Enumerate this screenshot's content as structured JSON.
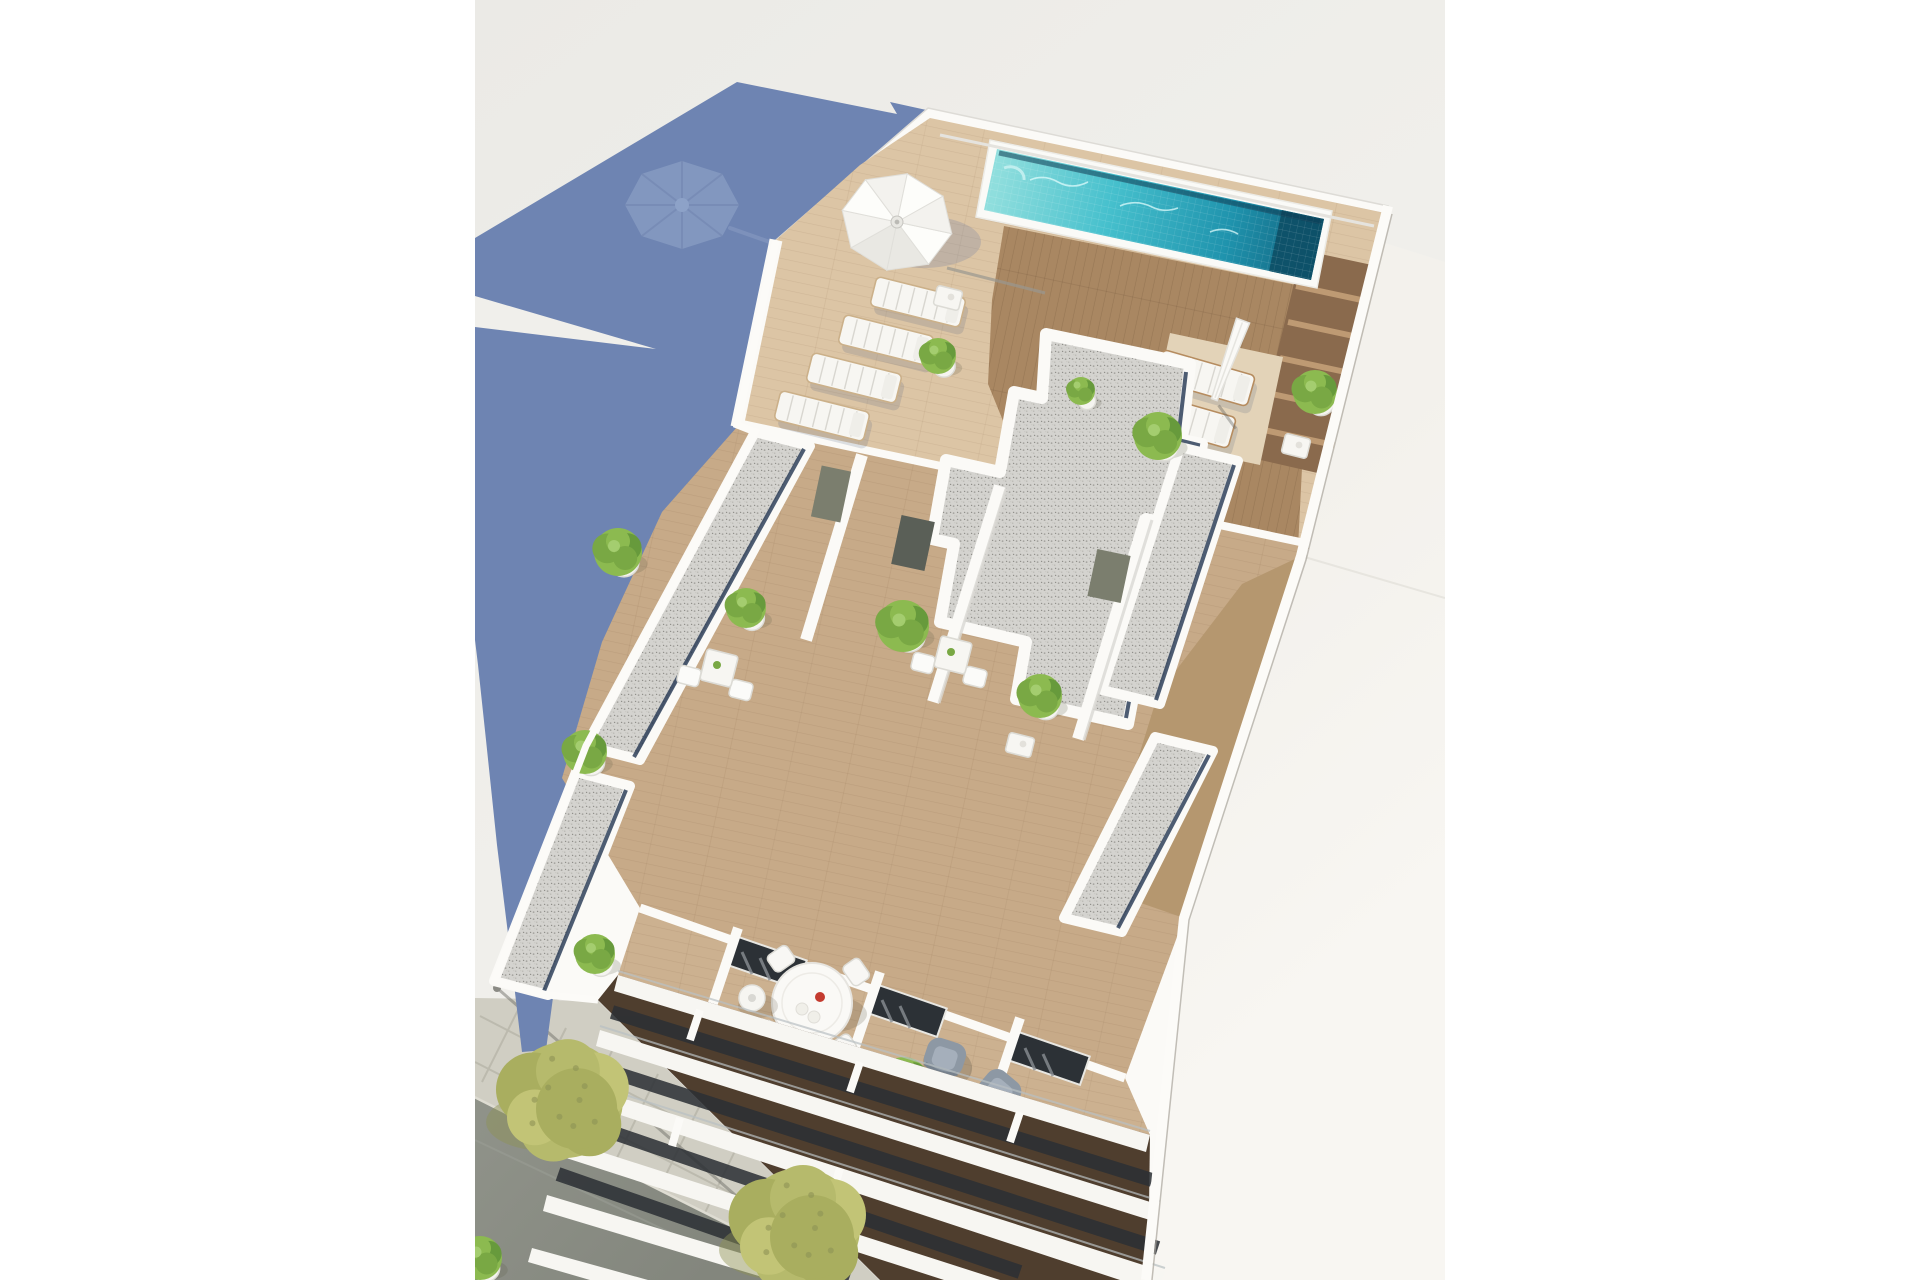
{
  "image": {
    "kind": "architectural-aerial-render",
    "description": "Aerial 3D rendering of a white residential building rooftop with a turquoise swimming pool, wooden deck terraces, sun loungers, white parasols, gravel flat roofs, cascading balconies and a tree-lined street below; a long blue building shadow is cast on the pale ground to the left."
  },
  "palette": {
    "page_bg": "#ffffff",
    "ground": "#ebeae6",
    "ground_mid": "#f0efeb",
    "ground_low": "#f3f2ed",
    "shadow_blue": "#6e84b2",
    "umbrella_shadow": "#93a7cb",
    "building_white": "#fbfaf7",
    "wall_shade": "#d9d8d3",
    "wall_edge": "#e5e3de",
    "deck_light": "#dcc5a5",
    "deck_warm": "#a98762",
    "deck_dark": "#8a6a4d",
    "deck_mat": "#e3d3b8",
    "wood_mid": "#c7aa88",
    "wood_right": "#b5976f",
    "wood_lt": "#ccb190",
    "recess_dark": "#4f3e2e",
    "gravel": "#d4d3cf",
    "gutter_navy": "#223450",
    "pool_light": "#8fdedd",
    "pool_mid": "#46c0cd",
    "pool_deep": "#1f93ad",
    "pool_dark": "#11607c",
    "pool_end": "#0d4f66",
    "road": "#8f9289",
    "road_low": "#83867d",
    "sidewalk": "#d0cec3",
    "paver_line": "#b9b7ab",
    "tree_a": "#b6ba6c",
    "tree_b": "#a9ae5f",
    "tree_c": "#c2c476",
    "tree_shadow": "#8e9355",
    "plant_a": "#8cba50",
    "plant_b": "#79a844",
    "plant_c": "#679a3c",
    "furniture_white": "#f7f6f2",
    "lounger_slat": "#d8d6d0",
    "armchair_gray": "#8d98a4",
    "glass_dark": "#2c3136",
    "door_olive": "#7b7e6e",
    "accent_red": "#c43b2f",
    "neigh_a": "#f3f1ec",
    "neigh_b": "#f8f6f2"
  },
  "scene": {
    "content_frame": {
      "x": 475,
      "y": 0,
      "width": 970,
      "height": 1280
    },
    "umbrella_shadow": {
      "x": 682,
      "y": 205,
      "rx": 57,
      "ry": 44
    },
    "parasol_roof": {
      "x": 897,
      "y": 222,
      "r": 56
    },
    "parasol_closed": {
      "x": 1228,
      "y": 362
    },
    "loungers_left": [
      {
        "x": 918,
        "y": 302
      },
      {
        "x": 886,
        "y": 340
      },
      {
        "x": 854,
        "y": 378
      },
      {
        "x": 822,
        "y": 416
      }
    ],
    "loungers_right": [
      {
        "x": 1205,
        "y": 378
      },
      {
        "x": 1186,
        "y": 420
      }
    ],
    "bistro_sets": [
      {
        "x": 719,
        "y": 668
      },
      {
        "x": 953,
        "y": 655
      }
    ],
    "side_tables": [
      {
        "x": 1020,
        "y": 745
      },
      {
        "x": 1296,
        "y": 446
      },
      {
        "x": 948,
        "y": 298
      }
    ],
    "dining_set": {
      "x": 812,
      "y": 1003,
      "r": 40
    },
    "floor_lamp": {
      "x": 752,
      "y": 998
    },
    "armchairs": [
      {
        "x": 945,
        "y": 1057,
        "a": 18
      },
      {
        "x": 1000,
        "y": 1090,
        "a": 40
      }
    ],
    "plants": [
      {
        "x": 620,
        "y": 556,
        "r": 24
      },
      {
        "x": 748,
        "y": 612,
        "r": 20
      },
      {
        "x": 905,
        "y": 630,
        "r": 26
      },
      {
        "x": 1042,
        "y": 700,
        "r": 22
      },
      {
        "x": 1160,
        "y": 440,
        "r": 24
      },
      {
        "x": 1317,
        "y": 396,
        "r": 22
      },
      {
        "x": 587,
        "y": 756,
        "r": 22
      },
      {
        "x": 597,
        "y": 958,
        "r": 20
      },
      {
        "x": 906,
        "y": 1085,
        "r": 24
      },
      {
        "x": 940,
        "y": 360,
        "r": 18
      },
      {
        "x": 1083,
        "y": 395,
        "r": 14
      },
      {
        "x": 482,
        "y": 1262,
        "r": 22
      }
    ],
    "trees": [
      {
        "x": 565,
        "y": 1100,
        "r": 58
      },
      {
        "x": 800,
        "y": 1228,
        "r": 60
      }
    ]
  }
}
